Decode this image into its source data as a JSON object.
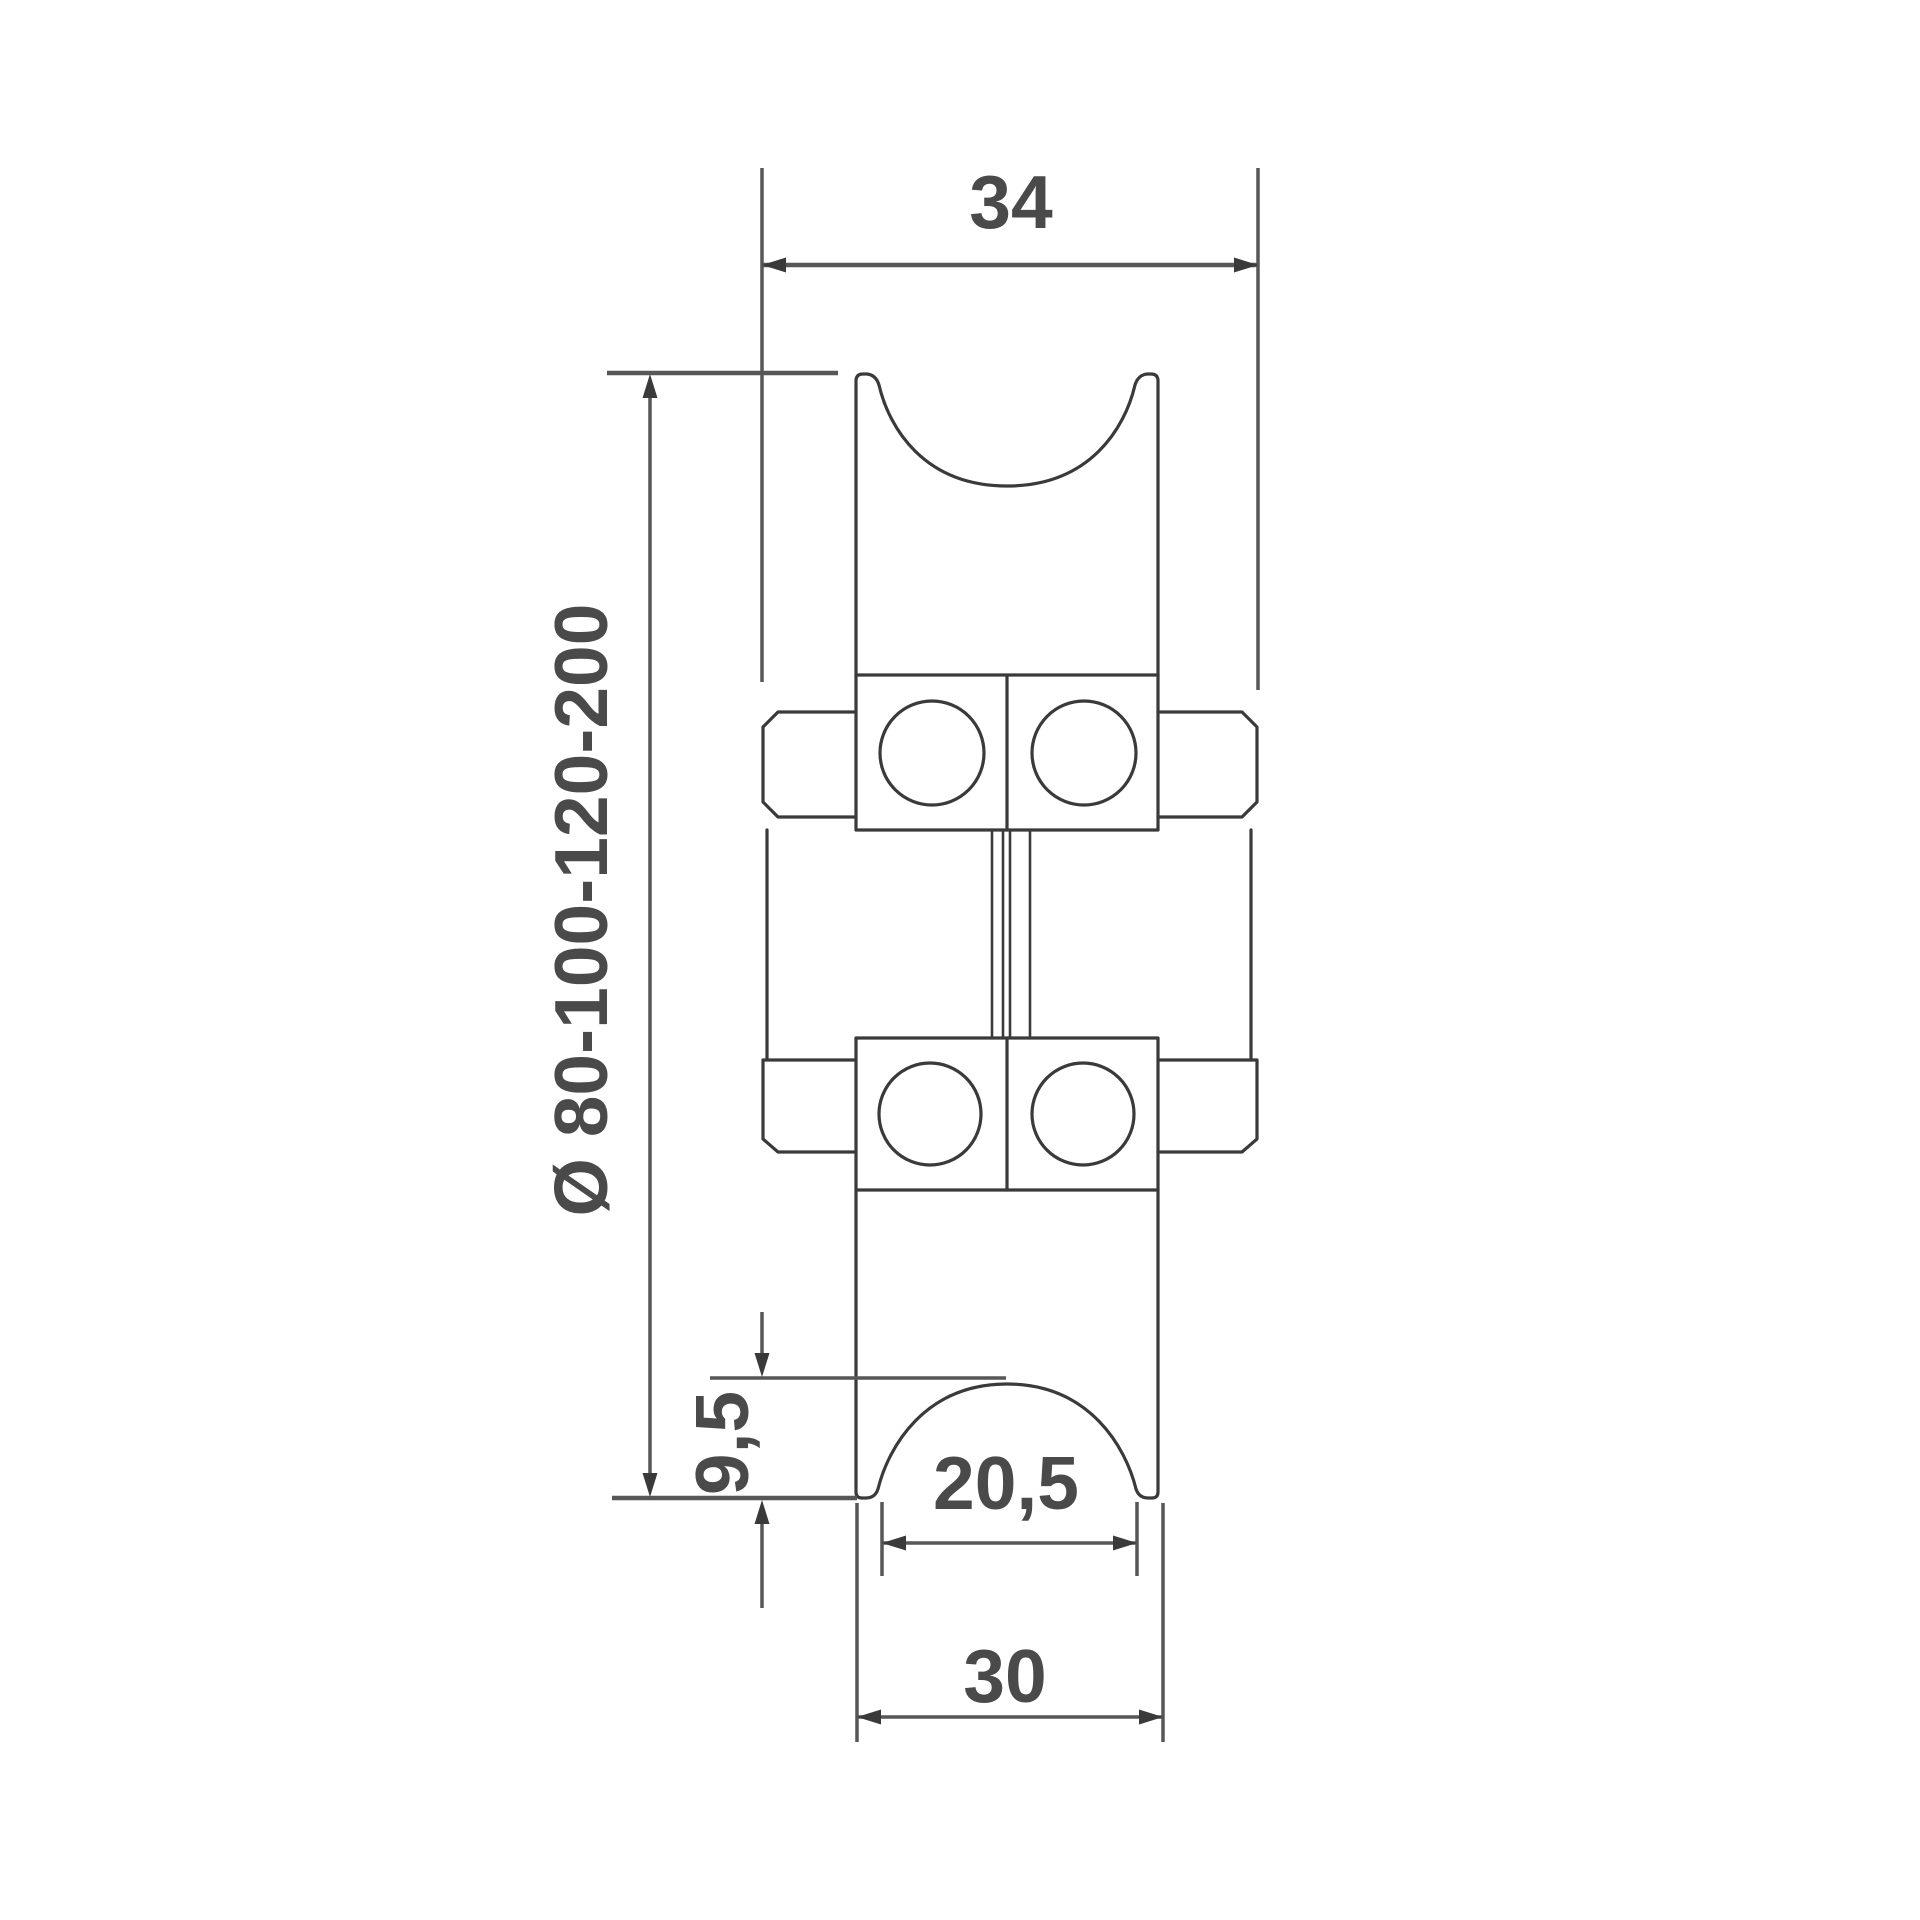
{
  "drawing": {
    "labels": {
      "width_top": "34",
      "diameter": "Ø 80-100-120-200",
      "groove_depth": "9,5",
      "groove_width": "20,5",
      "hub_width": "30"
    },
    "colors": {
      "outline": "#3a3a3a",
      "dimension_lines": "#575757",
      "text": "#4a4a4a",
      "background": "#ffffff"
    }
  }
}
